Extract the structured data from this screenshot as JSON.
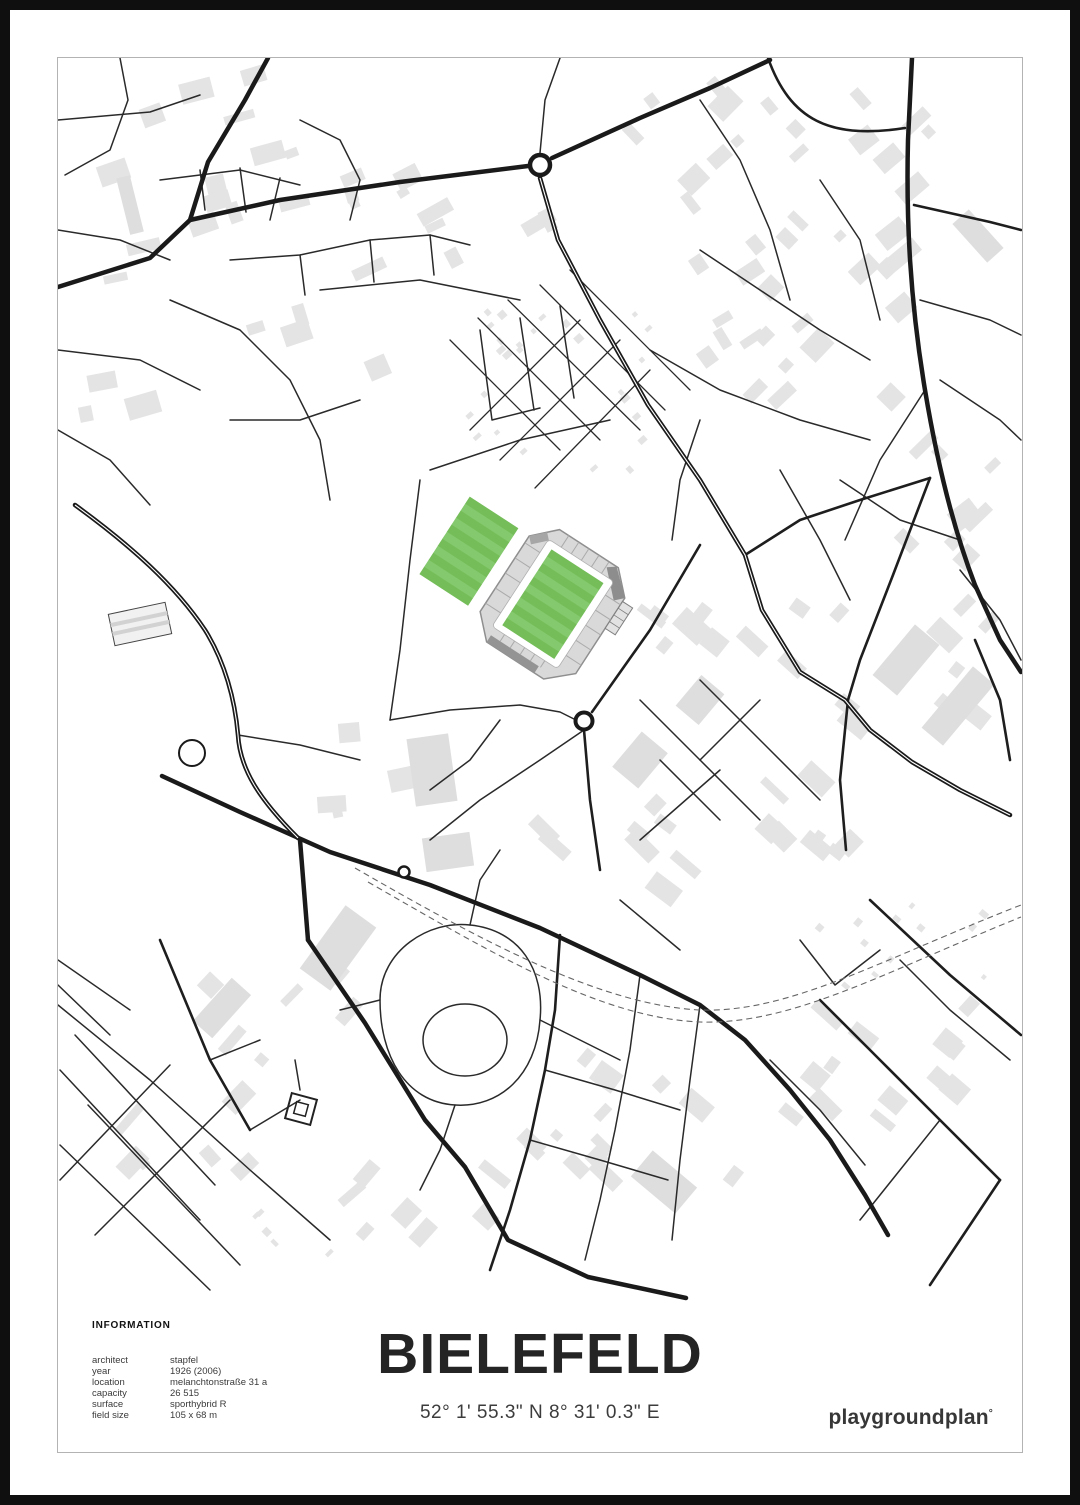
{
  "poster": {
    "title": "BIELEFELD",
    "coordinates": "52° 1' 55.3\" N  8° 31' 0.3\" E",
    "logo": "playgroundplan",
    "logo_mark": "°",
    "info": {
      "heading": "INFORMATION",
      "rows": [
        {
          "label": "architect",
          "value": "stapfel"
        },
        {
          "label": "year",
          "value": "1926 (2006)"
        },
        {
          "label": "location",
          "value": "melanchtonstraße 31 a"
        },
        {
          "label": "capacity",
          "value": "26 515"
        },
        {
          "label": "surface",
          "value": "sporthybrid R"
        },
        {
          "label": "field size",
          "value": "105 x 68 m"
        }
      ]
    },
    "map_legend": {
      "stadium_feature": "stadium with green pitch",
      "training_pitch_feature": "training pitch",
      "roundabout_feature": "roundabout",
      "railway_feature": "railway (dashed)"
    },
    "colors": {
      "pitch_green": "#74bd58",
      "pitch_green_light": "#84c96d",
      "stand_gray": "#d9d9d9",
      "building_gray": "#e4e4e4",
      "road_black": "#1e1e1e"
    }
  }
}
